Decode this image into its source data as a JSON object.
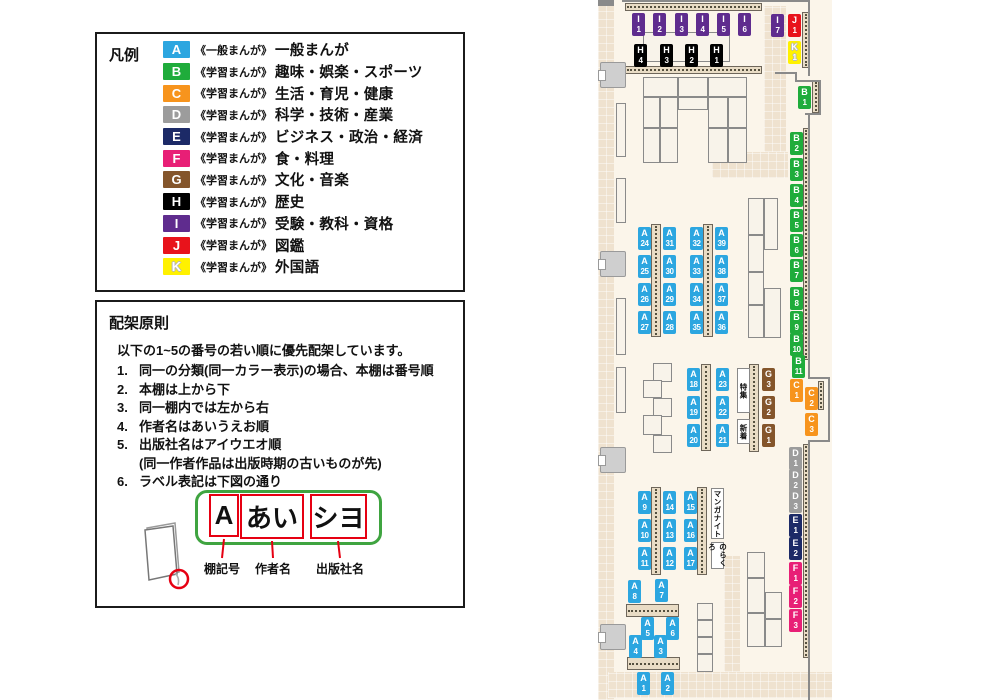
{
  "legend": {
    "title": "凡例",
    "items": [
      {
        "code": "A",
        "color": "#2CA6E0",
        "series": "《一般まんが》",
        "label": "一般まんが"
      },
      {
        "code": "B",
        "color": "#1FAC3B",
        "series": "《学習まんが》",
        "label": "趣味・娯楽・スポーツ"
      },
      {
        "code": "C",
        "color": "#F7941D",
        "series": "《学習まんが》",
        "label": "生活・育児・健康"
      },
      {
        "code": "D",
        "color": "#9C9C9C",
        "series": "《学習まんが》",
        "label": "科学・技術・産業"
      },
      {
        "code": "E",
        "color": "#1C2A67",
        "series": "《学習まんが》",
        "label": "ビジネス・政治・経済"
      },
      {
        "code": "F",
        "color": "#E81F76",
        "series": "《学習まんが》",
        "label": "食・料理"
      },
      {
        "code": "G",
        "color": "#84552B",
        "series": "《学習まんが》",
        "label": "文化・音楽"
      },
      {
        "code": "H",
        "color": "#000000",
        "series": "《学習まんが》",
        "label": "歴史"
      },
      {
        "code": "I",
        "color": "#5F2C8E",
        "series": "《学習まんが》",
        "label": "受験・教科・資格"
      },
      {
        "code": "J",
        "color": "#E8131B",
        "series": "《学習まんが》",
        "label": "図鑑"
      },
      {
        "code": "K",
        "color": "#FFF100",
        "series": "《学習まんが》",
        "label": "外国語",
        "outline": true
      }
    ]
  },
  "principles": {
    "title": "配架原則",
    "intro": "以下の1~5の番号の若い順に優先配架しています。",
    "rules": [
      {
        "num": "1.",
        "text": "同一の分類(同一カラー表示)の場合、本棚は番号順"
      },
      {
        "num": "2.",
        "text": "本棚は上から下"
      },
      {
        "num": "3.",
        "text": "同一棚内では左から右"
      },
      {
        "num": "4.",
        "text": "作者名はあいうえお順"
      },
      {
        "num": "5.",
        "text": "出版社名はアイウエオ順",
        "sub": "(同一作者作品は出版時期の古いものが先)"
      },
      {
        "num": "6.",
        "text": "ラベル表記は下図の通り"
      }
    ]
  },
  "label_diagram": {
    "boxes": [
      {
        "text": "A",
        "x": 112,
        "y": 7,
        "w": 30,
        "h": 43
      },
      {
        "text": "あい",
        "x": 143,
        "y": 7,
        "w": 64,
        "h": 45
      },
      {
        "text": "シヨ",
        "x": 213,
        "y": 7,
        "w": 57,
        "h": 45
      }
    ],
    "captions": [
      {
        "text": "棚記号",
        "x": 125
      },
      {
        "text": "作者名",
        "x": 176
      },
      {
        "text": "出版社名",
        "x": 243
      }
    ]
  },
  "map": {
    "paths": [
      [
        0,
        0,
        16,
        700
      ],
      [
        166,
        6,
        22,
        146
      ],
      [
        114,
        152,
        76,
        26
      ],
      [
        126,
        556,
        16,
        116
      ],
      [
        10,
        672,
        224,
        26
      ]
    ],
    "walls": [
      [
        24,
        0,
        188,
        2
      ],
      [
        210,
        0,
        2,
        76
      ],
      [
        177,
        72,
        22,
        2
      ],
      [
        197,
        72,
        2,
        10
      ],
      [
        197,
        80,
        26,
        2
      ],
      [
        221,
        80,
        2,
        35
      ],
      [
        207,
        113,
        16,
        2
      ],
      [
        210,
        113,
        2,
        266
      ],
      [
        210,
        377,
        22,
        2
      ],
      [
        230,
        377,
        2,
        65
      ],
      [
        210,
        440,
        22,
        2
      ],
      [
        210,
        442,
        2,
        258
      ],
      [
        0,
        0,
        16,
        6
      ]
    ],
    "strips": [
      [
        27,
        3,
        137,
        8
      ],
      [
        27,
        66,
        137,
        8
      ],
      [
        204,
        12,
        7,
        56
      ],
      [
        214,
        80,
        7,
        33
      ],
      [
        205,
        128,
        6,
        232
      ],
      [
        220,
        381,
        6,
        29
      ],
      [
        205,
        444,
        6,
        214
      ],
      [
        53,
        224,
        10,
        113
      ],
      [
        105,
        224,
        10,
        113
      ],
      [
        103,
        364,
        10,
        87
      ],
      [
        151,
        364,
        10,
        88
      ],
      [
        53,
        487,
        10,
        88
      ],
      [
        99,
        487,
        10,
        88
      ],
      [
        28,
        604,
        53,
        13
      ],
      [
        29,
        657,
        53,
        13
      ]
    ],
    "tables": [
      [
        45,
        32,
        87,
        30
      ],
      [
        45,
        77,
        35,
        20
      ],
      [
        80,
        77,
        30,
        20
      ],
      [
        110,
        77,
        39,
        20
      ],
      [
        45,
        97,
        17,
        31
      ],
      [
        62,
        97,
        18,
        31
      ],
      [
        80,
        97,
        30,
        13
      ],
      [
        110,
        97,
        20,
        31
      ],
      [
        130,
        97,
        19,
        31
      ],
      [
        45,
        128,
        17,
        35
      ],
      [
        62,
        128,
        18,
        35
      ],
      [
        110,
        128,
        20,
        35
      ],
      [
        130,
        128,
        19,
        35
      ],
      [
        150,
        198,
        16,
        37
      ],
      [
        150,
        235,
        16,
        37
      ],
      [
        150,
        272,
        16,
        33
      ],
      [
        150,
        305,
        16,
        33
      ],
      [
        166,
        198,
        14,
        52
      ],
      [
        166,
        288,
        17,
        50
      ],
      [
        55,
        363,
        19,
        19
      ],
      [
        45,
        380,
        19,
        18
      ],
      [
        55,
        398,
        19,
        19
      ],
      [
        45,
        415,
        19,
        20
      ],
      [
        55,
        435,
        19,
        18
      ],
      [
        149,
        552,
        18,
        26
      ],
      [
        149,
        578,
        18,
        35
      ],
      [
        149,
        613,
        18,
        34
      ],
      [
        167,
        592,
        17,
        27
      ],
      [
        167,
        619,
        17,
        28
      ],
      [
        99,
        603,
        16,
        17
      ],
      [
        99,
        620,
        16,
        17
      ],
      [
        99,
        637,
        16,
        17
      ],
      [
        99,
        654,
        16,
        18
      ],
      [
        18,
        103,
        10,
        54
      ],
      [
        18,
        178,
        10,
        45
      ],
      [
        18,
        298,
        10,
        57
      ],
      [
        18,
        367,
        10,
        46
      ]
    ],
    "doors": [
      [
        2,
        62
      ],
      [
        2,
        251
      ],
      [
        2,
        447
      ],
      [
        2,
        624
      ]
    ],
    "features": [
      {
        "text": "特集",
        "x": 139,
        "y": 368,
        "w": 13,
        "h": 45
      },
      {
        "text": "新着",
        "x": 139,
        "y": 419,
        "w": 13,
        "h": 25
      },
      {
        "text": "マンガナイト",
        "x": 113,
        "y": 488,
        "w": 13,
        "h": 51
      },
      {
        "text": "のらくろ",
        "x": 113,
        "y": 542,
        "w": 13,
        "h": 27
      }
    ],
    "labels": [
      {
        "c": "I",
        "n": "1",
        "x": 34,
        "y": 13
      },
      {
        "c": "I",
        "n": "2",
        "x": 55,
        "y": 13
      },
      {
        "c": "I",
        "n": "3",
        "x": 77,
        "y": 13
      },
      {
        "c": "I",
        "n": "4",
        "x": 98,
        "y": 13
      },
      {
        "c": "I",
        "n": "5",
        "x": 119,
        "y": 13
      },
      {
        "c": "I",
        "n": "6",
        "x": 140,
        "y": 13
      },
      {
        "c": "I",
        "n": "7",
        "x": 173,
        "y": 14
      },
      {
        "c": "J",
        "n": "1",
        "x": 190,
        "y": 14
      },
      {
        "c": "K",
        "n": "1",
        "x": 190,
        "y": 41
      },
      {
        "c": "H",
        "n": "4",
        "x": 36,
        "y": 44
      },
      {
        "c": "H",
        "n": "3",
        "x": 62,
        "y": 44
      },
      {
        "c": "H",
        "n": "2",
        "x": 87,
        "y": 44
      },
      {
        "c": "H",
        "n": "1",
        "x": 112,
        "y": 44
      },
      {
        "c": "B",
        "n": "1",
        "x": 200,
        "y": 86
      },
      {
        "c": "B",
        "n": "2",
        "x": 192,
        "y": 132
      },
      {
        "c": "B",
        "n": "3",
        "x": 192,
        "y": 158
      },
      {
        "c": "B",
        "n": "4",
        "x": 192,
        "y": 184
      },
      {
        "c": "B",
        "n": "5",
        "x": 192,
        "y": 209
      },
      {
        "c": "B",
        "n": "6",
        "x": 192,
        "y": 234
      },
      {
        "c": "B",
        "n": "7",
        "x": 192,
        "y": 259
      },
      {
        "c": "B",
        "n": "8",
        "x": 192,
        "y": 287
      },
      {
        "c": "B",
        "n": "9",
        "x": 192,
        "y": 311
      },
      {
        "c": "B",
        "n": "10",
        "x": 192,
        "y": 333
      },
      {
        "c": "B",
        "n": "11",
        "x": 194,
        "y": 355
      },
      {
        "c": "C",
        "n": "1",
        "x": 192,
        "y": 379
      },
      {
        "c": "C",
        "n": "2",
        "x": 207,
        "y": 387
      },
      {
        "c": "C",
        "n": "3",
        "x": 207,
        "y": 413
      },
      {
        "c": "D",
        "n": "1",
        "x": 191,
        "y": 447
      },
      {
        "c": "D",
        "n": "2",
        "x": 191,
        "y": 469
      },
      {
        "c": "D",
        "n": "3",
        "x": 191,
        "y": 490
      },
      {
        "c": "E",
        "n": "1",
        "x": 191,
        "y": 514
      },
      {
        "c": "E",
        "n": "2",
        "x": 191,
        "y": 537
      },
      {
        "c": "F",
        "n": "1",
        "x": 191,
        "y": 562
      },
      {
        "c": "F",
        "n": "2",
        "x": 191,
        "y": 585
      },
      {
        "c": "F",
        "n": "3",
        "x": 191,
        "y": 609
      },
      {
        "c": "G",
        "n": "3",
        "x": 164,
        "y": 368
      },
      {
        "c": "G",
        "n": "2",
        "x": 164,
        "y": 396
      },
      {
        "c": "G",
        "n": "1",
        "x": 164,
        "y": 424
      },
      {
        "c": "A",
        "n": "24",
        "x": 40,
        "y": 227
      },
      {
        "c": "A",
        "n": "31",
        "x": 65,
        "y": 227
      },
      {
        "c": "A",
        "n": "25",
        "x": 40,
        "y": 255
      },
      {
        "c": "A",
        "n": "30",
        "x": 65,
        "y": 255
      },
      {
        "c": "A",
        "n": "26",
        "x": 40,
        "y": 283
      },
      {
        "c": "A",
        "n": "29",
        "x": 65,
        "y": 283
      },
      {
        "c": "A",
        "n": "27",
        "x": 40,
        "y": 311
      },
      {
        "c": "A",
        "n": "28",
        "x": 65,
        "y": 311
      },
      {
        "c": "A",
        "n": "32",
        "x": 92,
        "y": 227
      },
      {
        "c": "A",
        "n": "39",
        "x": 117,
        "y": 227
      },
      {
        "c": "A",
        "n": "33",
        "x": 92,
        "y": 255
      },
      {
        "c": "A",
        "n": "38",
        "x": 117,
        "y": 255
      },
      {
        "c": "A",
        "n": "34",
        "x": 92,
        "y": 283
      },
      {
        "c": "A",
        "n": "37",
        "x": 117,
        "y": 283
      },
      {
        "c": "A",
        "n": "35",
        "x": 92,
        "y": 311
      },
      {
        "c": "A",
        "n": "36",
        "x": 117,
        "y": 311
      },
      {
        "c": "A",
        "n": "18",
        "x": 89,
        "y": 368
      },
      {
        "c": "A",
        "n": "23",
        "x": 118,
        "y": 368
      },
      {
        "c": "A",
        "n": "19",
        "x": 89,
        "y": 396
      },
      {
        "c": "A",
        "n": "22",
        "x": 118,
        "y": 396
      },
      {
        "c": "A",
        "n": "20",
        "x": 89,
        "y": 424
      },
      {
        "c": "A",
        "n": "21",
        "x": 118,
        "y": 424
      },
      {
        "c": "A",
        "n": "9",
        "x": 40,
        "y": 491
      },
      {
        "c": "A",
        "n": "14",
        "x": 65,
        "y": 491
      },
      {
        "c": "A",
        "n": "10",
        "x": 40,
        "y": 519
      },
      {
        "c": "A",
        "n": "13",
        "x": 65,
        "y": 519
      },
      {
        "c": "A",
        "n": "11",
        "x": 40,
        "y": 547
      },
      {
        "c": "A",
        "n": "12",
        "x": 65,
        "y": 547
      },
      {
        "c": "A",
        "n": "15",
        "x": 86,
        "y": 491
      },
      {
        "c": "A",
        "n": "16",
        "x": 86,
        "y": 519
      },
      {
        "c": "A",
        "n": "17",
        "x": 86,
        "y": 547
      },
      {
        "c": "A",
        "n": "8",
        "x": 30,
        "y": 580
      },
      {
        "c": "A",
        "n": "7",
        "x": 57,
        "y": 579
      },
      {
        "c": "A",
        "n": "5",
        "x": 43,
        "y": 617
      },
      {
        "c": "A",
        "n": "6",
        "x": 68,
        "y": 617
      },
      {
        "c": "A",
        "n": "4",
        "x": 31,
        "y": 635
      },
      {
        "c": "A",
        "n": "3",
        "x": 56,
        "y": 635
      },
      {
        "c": "A",
        "n": "1",
        "x": 39,
        "y": 672
      },
      {
        "c": "A",
        "n": "2",
        "x": 63,
        "y": 672
      }
    ]
  }
}
